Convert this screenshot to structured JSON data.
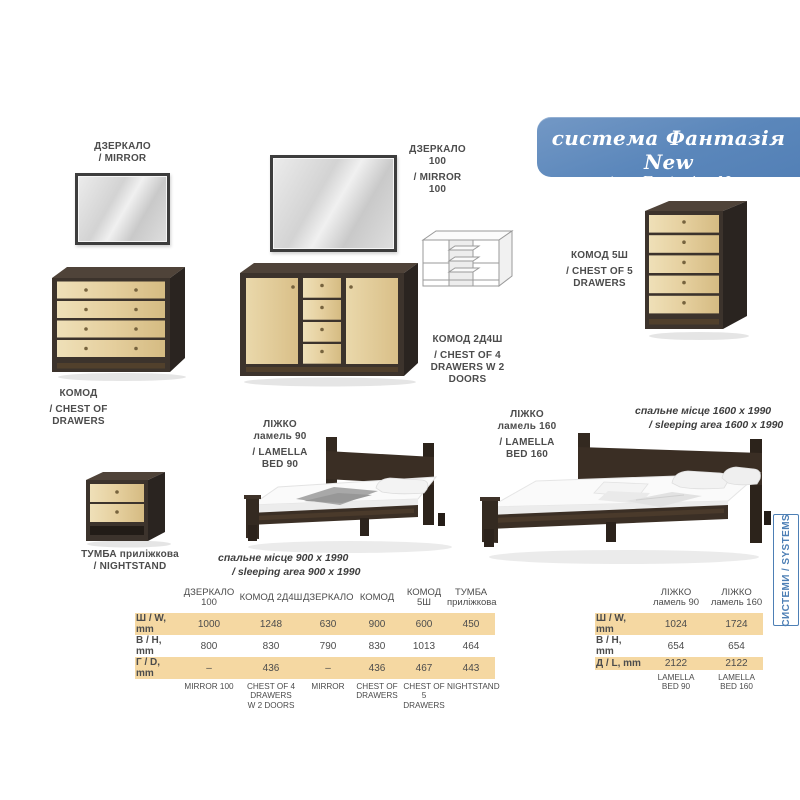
{
  "banner": {
    "title": "система Фантазія New",
    "subtitle": "system Fantaziya New",
    "bg_color": "#5b87bb"
  },
  "side_tab": {
    "label": "СИСТЕМИ / SYSTEMS",
    "color": "#4d7fb5"
  },
  "labels": {
    "mirror": [
      "ДЗЕРКАЛО",
      "/ MIRROR"
    ],
    "mirror100": [
      "ДЗЕРКАЛО",
      "100",
      "/ MIRROR",
      "100"
    ],
    "chest": [
      "КОМОД",
      "/ CHEST OF",
      "DRAWERS"
    ],
    "chest2d4": [
      "КОМОД 2Д4Ш",
      "/ CHEST OF 4",
      "DRAWERS W 2",
      "DOORS"
    ],
    "chest5": [
      "КОМОД 5Ш",
      "/ CHEST OF 5",
      "DRAWERS"
    ],
    "nightstand": [
      "ТУМБА приліжкова",
      "/ NIGHTSTAND"
    ],
    "bed90": [
      "ЛІЖКО",
      "ламель 90",
      "/ LAMELLA",
      "BED 90"
    ],
    "bed160": [
      "ЛІЖКО",
      "ламель 160",
      "/ LAMELLA",
      "BED 160"
    ],
    "bed90_area": [
      "спальне місце 900 х 1990",
      "/ sleeping area 900 x 1990"
    ],
    "bed160_area": [
      "спальне місце 1600 х 1990",
      "/ sleeping area 1600 x 1990"
    ]
  },
  "dimensions_table": {
    "columns": [
      [
        "ДЗЕРКАЛО",
        "100"
      ],
      [
        "КОМОД 2Д4Ш",
        ""
      ],
      [
        "ДЗЕРКАЛО",
        ""
      ],
      [
        "КОМОД",
        ""
      ],
      [
        "КОМОД",
        "5Ш"
      ],
      [
        "ТУМБА",
        "приліжкова"
      ]
    ],
    "rows": [
      {
        "label": "Ш / W, mm",
        "values": [
          "1000",
          "1248",
          "630",
          "900",
          "600",
          "450"
        ]
      },
      {
        "label": "В / H, mm",
        "values": [
          "800",
          "830",
          "790",
          "830",
          "1013",
          "464"
        ]
      },
      {
        "label": "Г / D, mm",
        "values": [
          "–",
          "436",
          "–",
          "436",
          "467",
          "443"
        ]
      }
    ],
    "footer": [
      [
        "MIRROR 100",
        ""
      ],
      [
        "CHEST OF 4 DRAWERS",
        "W 2 DOORS"
      ],
      [
        "MIRROR",
        ""
      ],
      [
        "CHEST OF",
        "DRAWERS"
      ],
      [
        "CHEST OF 5",
        "DRAWERS"
      ],
      [
        "NIGHTSTAND",
        ""
      ]
    ]
  },
  "beds_table": {
    "columns": [
      [
        "ЛІЖКО",
        "ламель 90"
      ],
      [
        "ЛІЖКО",
        "ламель 160"
      ]
    ],
    "rows": [
      {
        "label": "Ш / W, mm",
        "values": [
          "1024",
          "1724"
        ]
      },
      {
        "label": "В / H, mm",
        "values": [
          "654",
          "654"
        ]
      },
      {
        "label": "Д / L, mm",
        "values": [
          "2122",
          "2122"
        ]
      }
    ],
    "footer": [
      [
        "LAMELLA",
        "BED 90"
      ],
      [
        "LAMELLA",
        "BED 160"
      ]
    ]
  },
  "colors": {
    "accent_beige": "#f5d8a2",
    "wood_dark": "#3c332c",
    "wood_light": "#e5cf9e"
  }
}
